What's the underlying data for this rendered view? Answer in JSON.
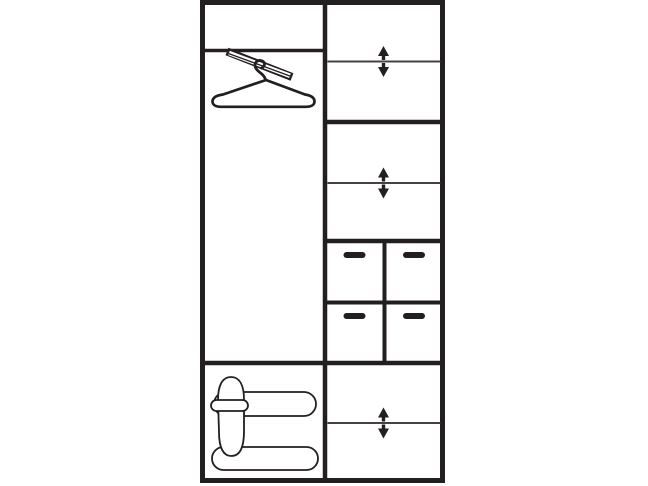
{
  "diagram": {
    "background": "#ffffff",
    "ink": "#231f20",
    "thin_ink": "#474242",
    "canvas": {
      "width": 648,
      "height": 486,
      "viewbox": "0 0 648 486"
    },
    "frame": {
      "x": 202.5,
      "y": 2.5,
      "width": 240,
      "height": 478,
      "stroke_width": 5
    },
    "structure_lines": [
      {
        "name": "center-vertical-divider",
        "x1": 325,
        "y1": 2,
        "x2": 325,
        "y2": 480,
        "stroke_width": 4.5
      },
      {
        "name": "left-top-shelf-divider",
        "x1": 202,
        "y1": 50.5,
        "x2": 325,
        "y2": 50.5,
        "stroke_width": 3.5
      },
      {
        "name": "right-section-divider-1",
        "x1": 325,
        "y1": 122,
        "x2": 443,
        "y2": 122,
        "stroke_width": 4.5
      },
      {
        "name": "right-section-divider-2",
        "x1": 325,
        "y1": 241,
        "x2": 443,
        "y2": 241,
        "stroke_width": 4.5
      },
      {
        "name": "drawer-row-divider",
        "x1": 325,
        "y1": 302.5,
        "x2": 443,
        "y2": 302.5,
        "stroke_width": 4
      },
      {
        "name": "drawer-column-divider",
        "x1": 384.5,
        "y1": 241,
        "x2": 384.5,
        "y2": 363,
        "stroke_width": 4
      },
      {
        "name": "full-width-divider",
        "x1": 202,
        "y1": 363,
        "x2": 443,
        "y2": 363,
        "stroke_width": 4.5
      }
    ],
    "shelf_line_stroke": 2,
    "adjustable_shelves": [
      {
        "y": 61.5,
        "x1": 327.5,
        "x2": 440.5,
        "arrow_x": 383.5
      },
      {
        "y": 183,
        "x1": 327.5,
        "x2": 440.5,
        "arrow_x": 383.5
      },
      {
        "y": 423,
        "x1": 327.5,
        "x2": 440.5,
        "arrow_x": 383.5
      }
    ],
    "arrow": {
      "tri_half_w": 5.5,
      "tri_h": 10,
      "stem_half_w": 1.7,
      "stem_len": 4,
      "gap": 1.5
    },
    "drawer_handles": {
      "width": 22,
      "height": 6,
      "radius": 3,
      "positions": [
        {
          "cx": 354.5,
          "cy": 255
        },
        {
          "cx": 414,
          "cy": 255
        },
        {
          "cx": 354.5,
          "cy": 316
        },
        {
          "cx": 414,
          "cy": 316
        }
      ]
    },
    "icons": [
      {
        "symbol": "hanger",
        "name": "clothes-hanger-icon",
        "x": 212,
        "y": 48
      },
      {
        "symbol": "shoes",
        "name": "shoes-icon",
        "x": 208,
        "y": 374
      }
    ],
    "compartments": [
      {
        "id": "left-top",
        "label": "upper shelf compartment"
      },
      {
        "id": "left-middle",
        "label": "hanging compartment with clothes rail and hanger"
      },
      {
        "id": "left-bottom",
        "label": "shoe storage compartment"
      },
      {
        "id": "right-top",
        "label": "compartment with height-adjustable shelf"
      },
      {
        "id": "right-upper-mid",
        "label": "compartment with height-adjustable shelf"
      },
      {
        "id": "right-drawers",
        "label": "four drawers in two rows with pull handles"
      },
      {
        "id": "right-bottom",
        "label": "compartment with height-adjustable shelf"
      }
    ]
  }
}
